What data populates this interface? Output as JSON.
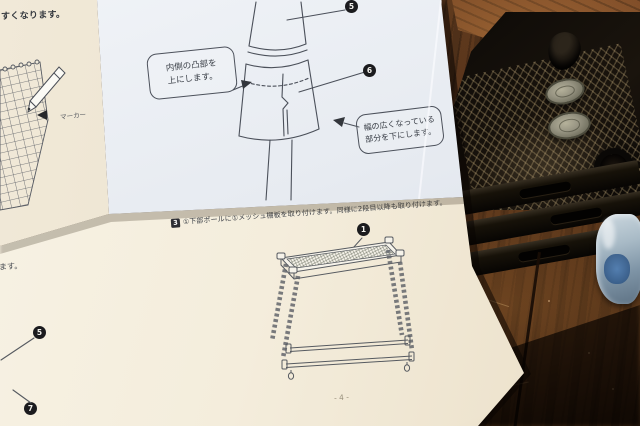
{
  "colors": {
    "paper_blue_white": "#e7ebf1",
    "paper_cream": "#f4eedd",
    "ink": "#454952",
    "badge_bg": "#1b1b1e",
    "wood_mid": "#5a3519",
    "wood_dark": "#241409",
    "crate_black": "#16110c",
    "jar_lid": "#908d79",
    "bag_blue": "#3f6fa0"
  },
  "manual": {
    "left_page": {
      "top_fragment": "すくなります。",
      "marker_label": "マーカー",
      "bottom_fragment": "ます。",
      "badges": {
        "b5": "5",
        "b7": "7"
      }
    },
    "pole_page": {
      "callout_inner_line1": "内側の凸部を",
      "callout_inner_line2": "上にします。",
      "callout_wide_line1": "幅の広くなっている",
      "callout_wide_line2": "部分を下にします。",
      "badges": {
        "b5": "5",
        "b6": "6"
      }
    },
    "shelf_page": {
      "step_number": "3",
      "instruction": "①下部ポールに①メッシュ棚板を取り付けます。同様に2段目以降も取り付けます。",
      "badges": {
        "b1": "1"
      },
      "page_number": "- 4 -"
    }
  }
}
